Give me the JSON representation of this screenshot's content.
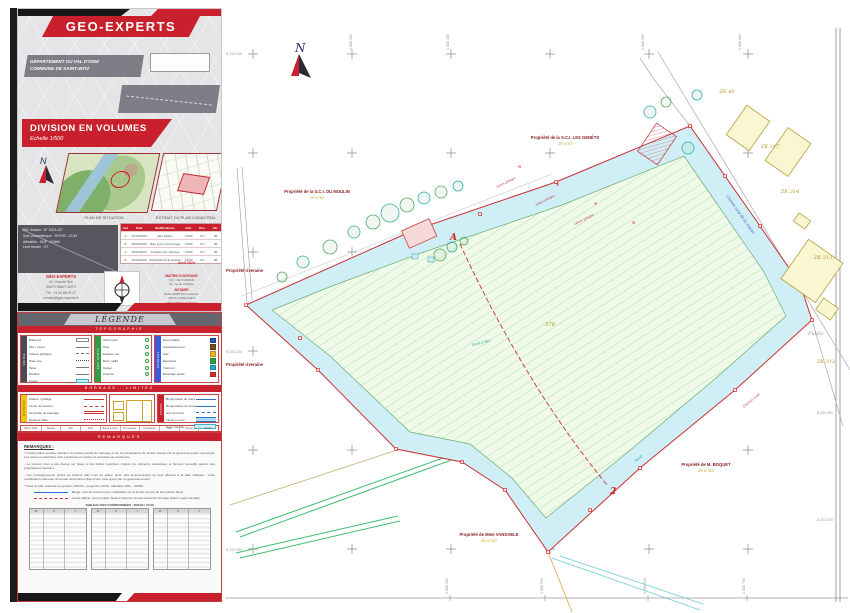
{
  "sheet": {
    "company": "GEO-EXPERTS",
    "department": "DÉPARTEMENT DU VAL D'OISE",
    "commune": "COMMUNE DE SAINT-WITZ",
    "doc_title": "DIVISION EN VOLUMES",
    "doc_scale": "Echelle 1/500",
    "inset_left_caption": "PLAN DE SITUATION",
    "inset_right_caption": "EXTRAIT DU PLAN CADASTRAL",
    "north_label": "N",
    "info_box": {
      "l1": "Réf. dossier : N° 2023-157",
      "l2": "Syst. planimétrique : RGF93 - CC49",
      "l3": "Altimétrie : NGF - IGN69",
      "l4": "Levé terrain : GT"
    },
    "revision": {
      "headers": [
        "Ind",
        "Date",
        "Modifications",
        "Ech.",
        "Des.",
        "Vér."
      ],
      "rows": [
        [
          "A",
          "12/04/2023",
          "1ère édition",
          "1/500",
          "GT",
          "JB"
        ],
        [
          "B",
          "06/07/2023",
          "Mise à jour du bornage",
          "1/500",
          "GT",
          "JB"
        ],
        [
          "C",
          "18/10/2023",
          "Création des volumes",
          "1/500",
          "GT",
          "JB"
        ],
        [
          "D",
          "22/01/2024",
          "Modificatif de la division",
          "1/500",
          "GT",
          "JB"
        ]
      ],
      "issue_note": "Avril 2024"
    },
    "office": {
      "name": "GÉO-EXPERTS",
      "a1": "42, Grande Rue",
      "a2": "95470 SAINT-WITZ",
      "a3": "Tél : 01 34 68 52 47",
      "a4": "contact@geo-experts.fr"
    },
    "contacts": [
      {
        "title": "MAÎTRE D'OUVRAGE",
        "l1": "S.C.I. DES MARAIS",
        "l2": "12, rue de la Mairie"
      },
      {
        "title": "NOTAIRE",
        "l1": "Étude MARTIN & Associés",
        "l2": "95270 LUZARCHES"
      },
      {
        "title": "GÉOMÈTRE-EXPERT",
        "l1": "Cabinet GÉO-EXPERTS",
        "l2": "Inscrit à l'OGE n° 2023C"
      }
    ]
  },
  "legend": {
    "title": "LÉGENDE",
    "band_topo": "TOPOGRAPHIE",
    "band_mid": "BORNAGE - LIMITES",
    "band_bottom": "DIVISION EN VOLUMES",
    "tab_voirie": "VOIRIE",
    "tab_vert": "ESP. VERTS",
    "tab_reseaux": "RÉSEAUX",
    "tab_division": "DIVISION",
    "tab_fosse": "FOSSÉ",
    "topo": [
      "Bâtiment",
      "Mur / muret",
      "Clôture grillagée",
      "Haie vive",
      "Talus",
      "Bordure",
      "Fossé"
    ],
    "vert": [
      "Arbre isolé",
      "Haie",
      "Espace vert",
      "Bois / taillis",
      "Verger",
      "Pelouse"
    ],
    "networks": [
      {
        "label": "Eau potable",
        "color": "#2a52be"
      },
      {
        "label": "Assainissement",
        "color": "#7a4a22"
      },
      {
        "label": "Gaz",
        "color": "#e8b820"
      },
      {
        "label": "Électricité",
        "color": "#2f9e44"
      },
      {
        "label": "Télécom",
        "color": "#1fb0c4"
      },
      {
        "label": "Éclairage public",
        "color": "#d03030"
      }
    ],
    "division_lines": [
      "Clôture / grillage",
      "Limite de division",
      "Servitude de passage",
      "Emprise bâtie"
    ],
    "fosse_lines": [
      "Berge haute du fossé",
      "Berge basse du fossé",
      "Axe du fossé",
      "Limite en eau",
      "Zone humide"
    ],
    "symbols": [
      {
        "label": "Borne OGE",
        "glyph": "▪"
      },
      {
        "label": "Repère",
        "glyph": "⊗"
      },
      {
        "label": "Spit",
        "glyph": "▲"
      },
      {
        "label": "Clou",
        "glyph": "✕"
      },
      {
        "label": "Borne à créer",
        "glyph": "◻"
      },
      {
        "label": "Pt nouveau",
        "glyph": "⊞"
      },
      {
        "label": "Pt retrouvé",
        "glyph": "◯"
      },
      {
        "label": "Axe",
        "glyph": "✚"
      },
      {
        "label": "Piquet",
        "glyph": "◆"
      },
      {
        "label": "Station",
        "glyph": "△"
      }
    ]
  },
  "remarks": {
    "band_title": "REMARQUES",
    "heading": "REMARQUES :",
    "p1": "* Limites telles qu'elles résultent du procès-verbal de bornage et de reconnaissance de limites dressé par le géomètre-expert soussigné. Les cotes et superficies sont exprimées en mètres et arrondies au centimètre.",
    "p2": "- Le présent plan a été dressé sur place et les limites reportées d'après les éléments cadastraux et fonciers recueillis auprès des propriétaires riverains.",
    "p3": "- Les renseignements portés au présent plan n'ont de valeur qu'en tant qu'accessoires du levé effectué à la date indiquée ; toute modification ultérieure du terrain devra faire l'objet d'une mise à jour par un géomètre-expert.",
    "p4": "* Fond de plan rattaché au système RGF93 - projection CC49 ; altimétrie NGF - IGN69.",
    "note_blue": "Berge / axe du fossé tel que matérialisé sur le terrain au jour du levé (liseré bleu).",
    "note_red": "Limite définie, point projeté, faisant l'objet du procès-verbal de bornage (liseré rouge pointillé).",
    "coord_title": "TABLEAU DES COORDONNÉES - RGF93 / CC49",
    "coord_headers": [
      "N°",
      "X",
      "Y"
    ]
  },
  "map": {
    "north_label": "N",
    "owners": [
      {
        "name": "Propriété de la S.C.I. DU MOULIN",
        "parcel": "ZK n°52"
      },
      {
        "name": "Propriété de la S.C.I. LES GENÊTS",
        "parcel": "ZK n°57"
      },
      {
        "name": "Propriété de M. BOQUET",
        "parcel": "ZK n°323"
      },
      {
        "name": "Propriété de Mme VANDAELE",
        "parcel": "ZK n°322"
      },
      {
        "name": "Propriété riveraine",
        "parcel": "ZK n°51"
      },
      {
        "name": "Propriété riveraine",
        "parcel": "ZK n°50"
      }
    ],
    "parcels": [
      "ZK 48",
      "ZK 317",
      "ZK 314",
      "ZK 313",
      "ZK 312"
    ],
    "field_number": "376",
    "ditch_label": "fossé n°361",
    "ditch_label2": "fossé",
    "road_label": "Chemin rural dit du Marais",
    "road_label2": "Chemin rural",
    "public_label": "Public",
    "fence_label": "clôture grillagée",
    "division_a": "A",
    "division_b": "2",
    "grid": {
      "top": [
        "1 688 300",
        "1 688 400",
        "1 688 500",
        "1 688 600"
      ],
      "bottom": [
        "1 688 400",
        "1 688 500",
        "1 688 600",
        "1 688 700"
      ],
      "left": [
        "8 233 500",
        "8 233 400",
        "8 233 300"
      ],
      "right": [
        "8 233 500",
        "8 233 400",
        "8 233 300"
      ]
    }
  }
}
